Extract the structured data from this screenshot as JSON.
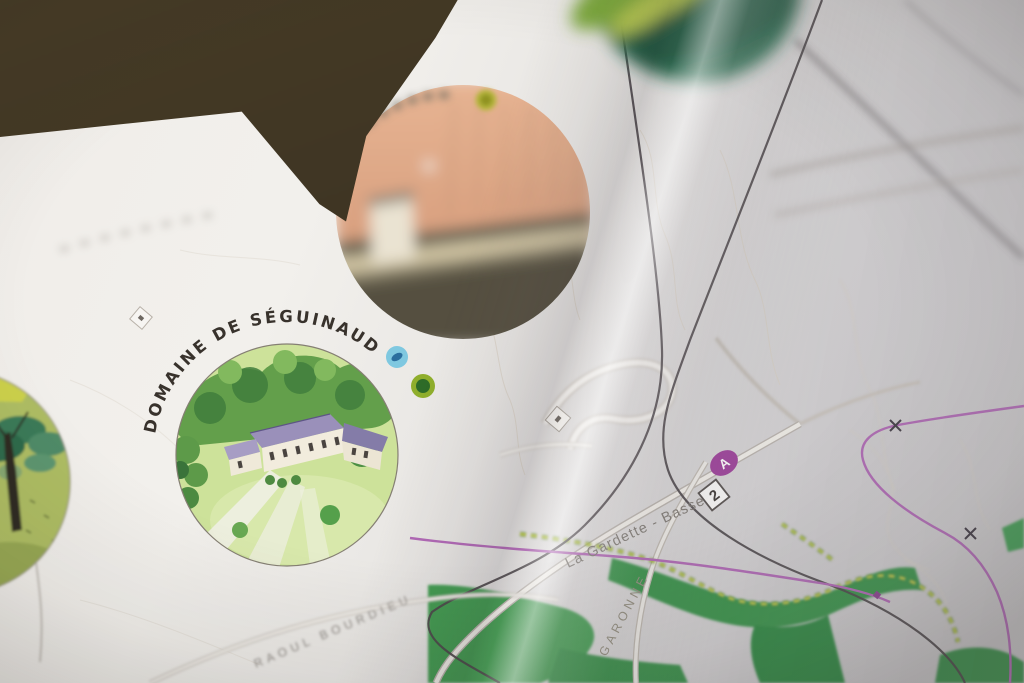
{
  "map": {
    "vignettes": {
      "seguinaud": {
        "label": "DOMAINE DE SÉGUINAUD",
        "icons": [
          {
            "name": "water-badge-icon",
            "color": "#7fc8e0"
          },
          {
            "name": "nature-badge-icon",
            "color": "#8fae2c"
          }
        ]
      },
      "top_blurred": {
        "icons": [
          {
            "name": "activity-badge-icon",
            "color": "#b5b63a"
          }
        ]
      }
    },
    "labels": {
      "main_road": "La Gardette - Bassens",
      "street": "RAOUL BOURDIEU",
      "riverside": "GARONNE"
    },
    "badges": {
      "transit_line": "A",
      "road_number": "2"
    },
    "colors": {
      "route_purple": "#b168b6",
      "transit_badge_purple": "#9d3f9a",
      "park_green": "#3f9b50",
      "trail_dash_yellow": "#cbd54e",
      "road_dark": "#4b4549",
      "paper_white": "#efece8",
      "table_dark": "#3a3122"
    }
  }
}
